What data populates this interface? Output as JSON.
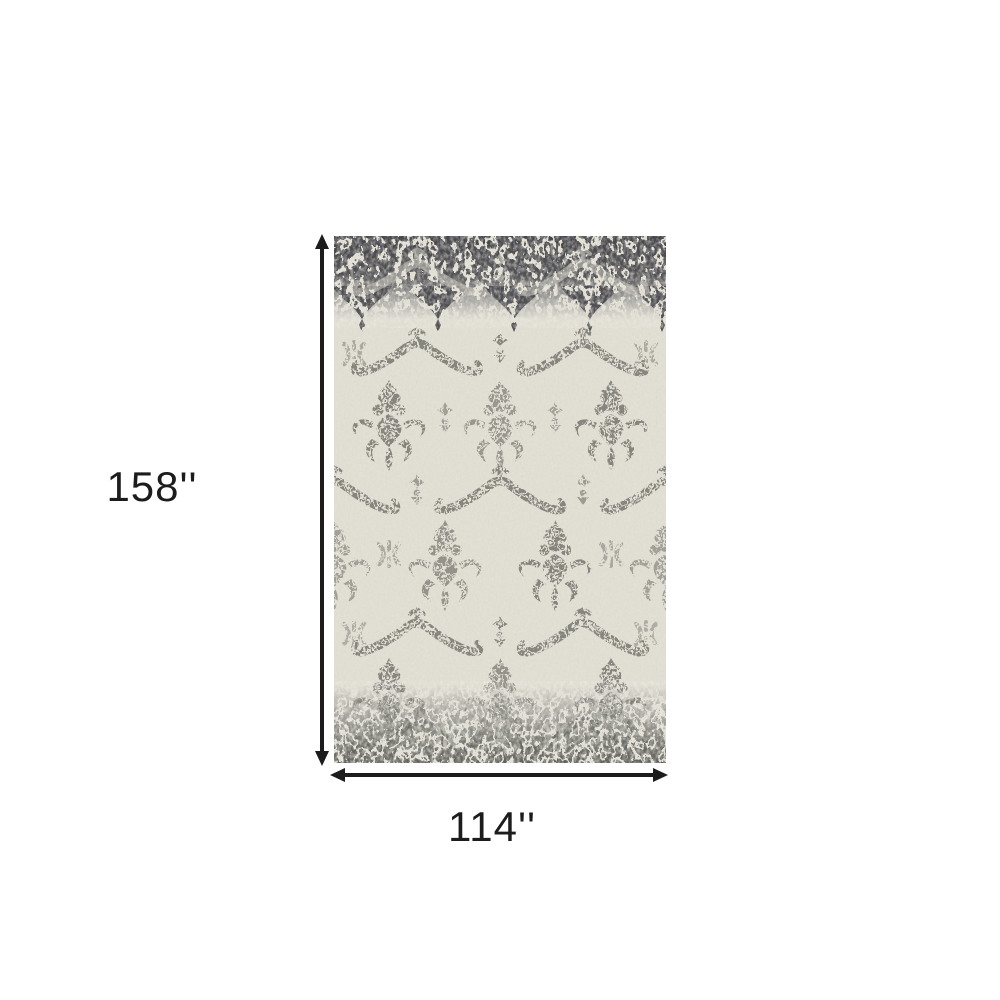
{
  "colors": {
    "page-bg": "#ffffff",
    "dimension": "#1c1c1c",
    "rug-field": "#e3e0d5",
    "rug-pattern": "#86867f",
    "rug-pattern-light": "#cbc8bd",
    "rug-band-dark": "#45454a",
    "rug-band-bottom": "#6e6e68"
  },
  "diagram": {
    "height_label": "158''",
    "width_label": "114''",
    "rug_alt": "Ivory and gray distressed damask area rug with dark gray fading bands at top and bottom"
  }
}
